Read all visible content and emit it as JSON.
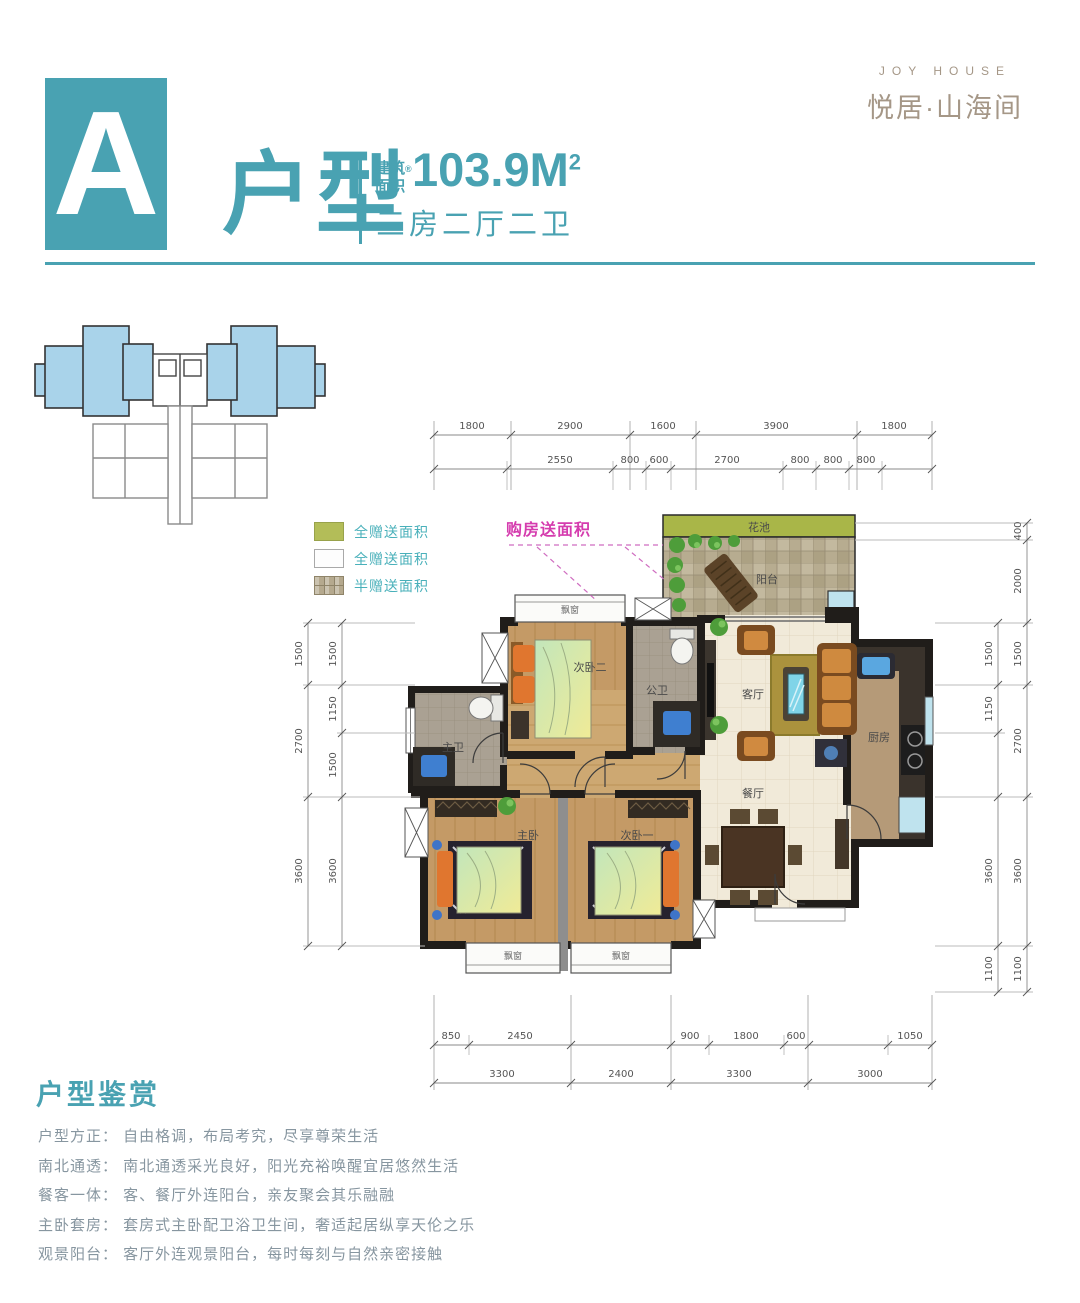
{
  "header": {
    "unit_letter": "A",
    "type_label": "户型",
    "area_label_1": "建筑",
    "area_label_2": "面积",
    "area_mark": "®",
    "area_value": "103.9M",
    "area_sup": "2",
    "layout_desc": "三房二厅二卫"
  },
  "brand": {
    "en": "JOY HOUSE",
    "cn": "悦居·山海间"
  },
  "legend": {
    "items": [
      {
        "label": "全赠送面积"
      },
      {
        "label": "全赠送面积"
      },
      {
        "label": "半赠送面积"
      }
    ],
    "gift_label": "购房送面积"
  },
  "plan": {
    "rooms": {
      "flower_bed": "花池",
      "balcony": "阳台",
      "bay_window": "飘窗",
      "bedroom2": "次卧二",
      "public_bath": "公卫",
      "living": "客厅",
      "kitchen": "厨房",
      "master_bath": "主卫",
      "dining": "餐厅",
      "master_bedroom": "主卧",
      "bedroom1": "次卧一"
    }
  },
  "dims": {
    "top1": [
      "1800",
      "2900",
      "1600",
      "3900",
      "1800"
    ],
    "top2": [
      "2550",
      "800",
      "600",
      "2700",
      "800",
      "800",
      "800"
    ],
    "bottom1": [
      "850",
      "2450",
      "900",
      "1800",
      "600",
      "1050"
    ],
    "bottom2": [
      "3300",
      "2400",
      "3300",
      "3000"
    ],
    "left_outer": [
      "1500",
      "2700",
      "3600"
    ],
    "left_inner": [
      "1500",
      "1150",
      "1500",
      "3600"
    ],
    "right_inner": [
      "1500",
      "1150",
      "3600",
      "1100"
    ],
    "right_outer": [
      "400",
      "2000",
      "1500",
      "2700",
      "3600",
      "1100"
    ]
  },
  "appreciation": {
    "title": "户型鉴赏",
    "lines": [
      "户型方正： 自由格调，布局考究，尽享尊荣生活",
      "南北通透： 南北通透采光良好，阳光充裕唤醒宜居悠然生活",
      "餐客一体： 客、餐厅外连阳台，亲友聚会其乐融融",
      "主卧套房： 套房式主卧配卫浴卫生间，奢适起居纵享天伦之乐",
      "观景阳台： 客厅外连观景阳台，每时每刻与自然亲密接触"
    ]
  }
}
